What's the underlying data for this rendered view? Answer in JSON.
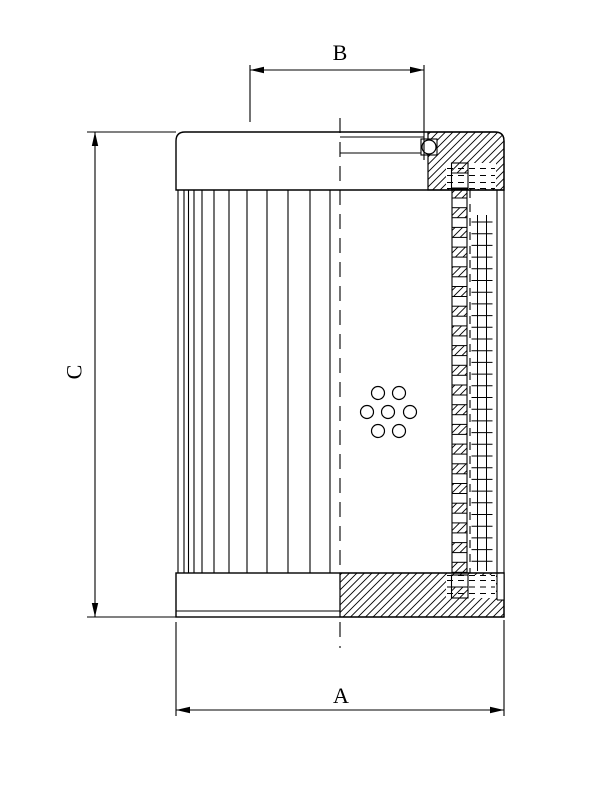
{
  "drawing": {
    "dimension_labels": {
      "overall_width": "A",
      "seal_diameter": "B",
      "overall_height": "C"
    },
    "colors": {
      "line": "#000000",
      "background": "#ffffff"
    }
  }
}
